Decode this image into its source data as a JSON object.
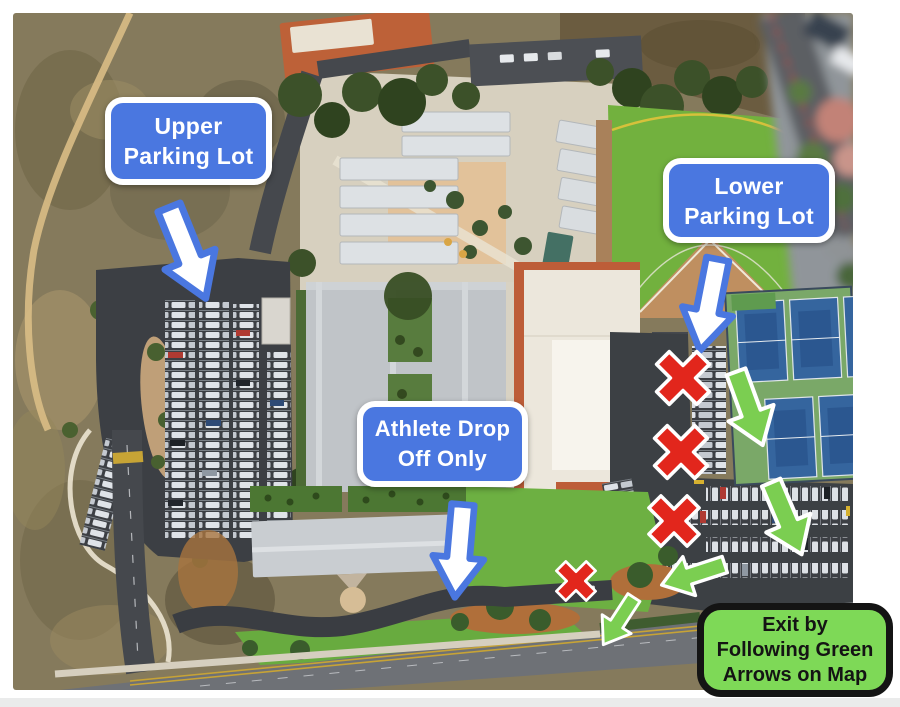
{
  "page": {
    "background": "#ffffff",
    "bottom_strip_color": "#eaebeb"
  },
  "labels": {
    "upper_parking_lot": {
      "line1": "Upper",
      "line2": "Parking Lot"
    },
    "lower_parking_lot": {
      "line1": "Lower",
      "line2": "Parking Lot"
    },
    "athlete_drop_off": {
      "line1": "Athlete Drop",
      "line2": "Off Only"
    },
    "exit_instructions": {
      "line1": "Exit by",
      "line2": "Following Green",
      "line3": "Arrows on Map"
    }
  },
  "colors": {
    "label_blue": "#4a77e0",
    "label_border": "#ffffff",
    "label_text": "#ffffff",
    "exit_green": "#7ed957",
    "exit_border": "#141414",
    "exit_text": "#141414",
    "white_arrow_fill": "#ffffff",
    "white_arrow_outline": "#4a77e0",
    "green_arrow_fill": "#7bce51",
    "green_arrow_outline": "#ffffff",
    "red_x_fill": "#e2261c",
    "red_x_outline": "#ffffff"
  },
  "icons": {
    "white_arrow": "block-arrow-down",
    "green_arrow": "block-arrow-down",
    "red_x": "cross-x"
  },
  "annotation_counts": {
    "white_arrows": 3,
    "green_arrows": 4,
    "red_x_marks": 4
  }
}
